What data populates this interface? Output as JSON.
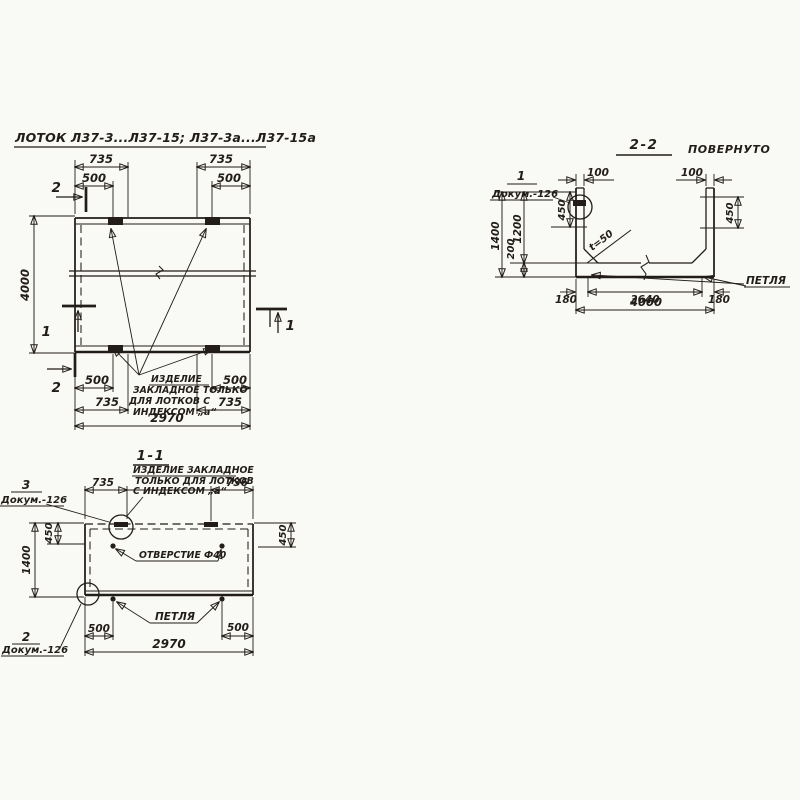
{
  "plan": {
    "title": "ЛОТОК Л37-3...Л37-15; Л37-3а...Л37-15а",
    "marker_1": "1",
    "marker_2": "2",
    "dim_735": "735",
    "dim_500": "500",
    "dim_4000": "4000",
    "dim_2970": "2970",
    "note_line1": "ИЗДЕЛИЕ",
    "note_line2": "ЗАКЛАДНОЕ ТОЛЬКО",
    "note_line3": "ДЛЯ ЛОТКОВ С",
    "note_line4": "ИНДЕКСОМ „а“"
  },
  "s22": {
    "title": "2-2",
    "subtitle": "ПОВЕРНУТО",
    "callout_num": "1",
    "doc_label": "Докум.-126",
    "dim_100": "100",
    "dim_450": "450",
    "dim_1400": "1400",
    "dim_1200": "1200",
    "dim_200": "200",
    "dim_180": "180",
    "dim_3640": "3640",
    "dim_4000": "4000",
    "chamfer_note": "t=50",
    "loop_label": "ПЕТЛЯ"
  },
  "s11": {
    "title": "1-1",
    "note_line1": "ИЗДЕЛИЕ ЗАКЛАДНОЕ",
    "note_line2": "ТОЛЬКО ДЛЯ ЛОТКОВ",
    "note_line3": "С ИНДЕКСОМ „а“",
    "callout3_num": "3",
    "callout2_num": "2",
    "doc_label": "Докум.-126",
    "dim_735": "735",
    "dim_736": "736",
    "dim_450": "450",
    "dim_1400": "1400",
    "hole_label": "ОТВЕРСТИЕ Ф40",
    "loop_label": "ПЕТЛЯ",
    "dim_500": "500",
    "dim_2970": "2970"
  }
}
